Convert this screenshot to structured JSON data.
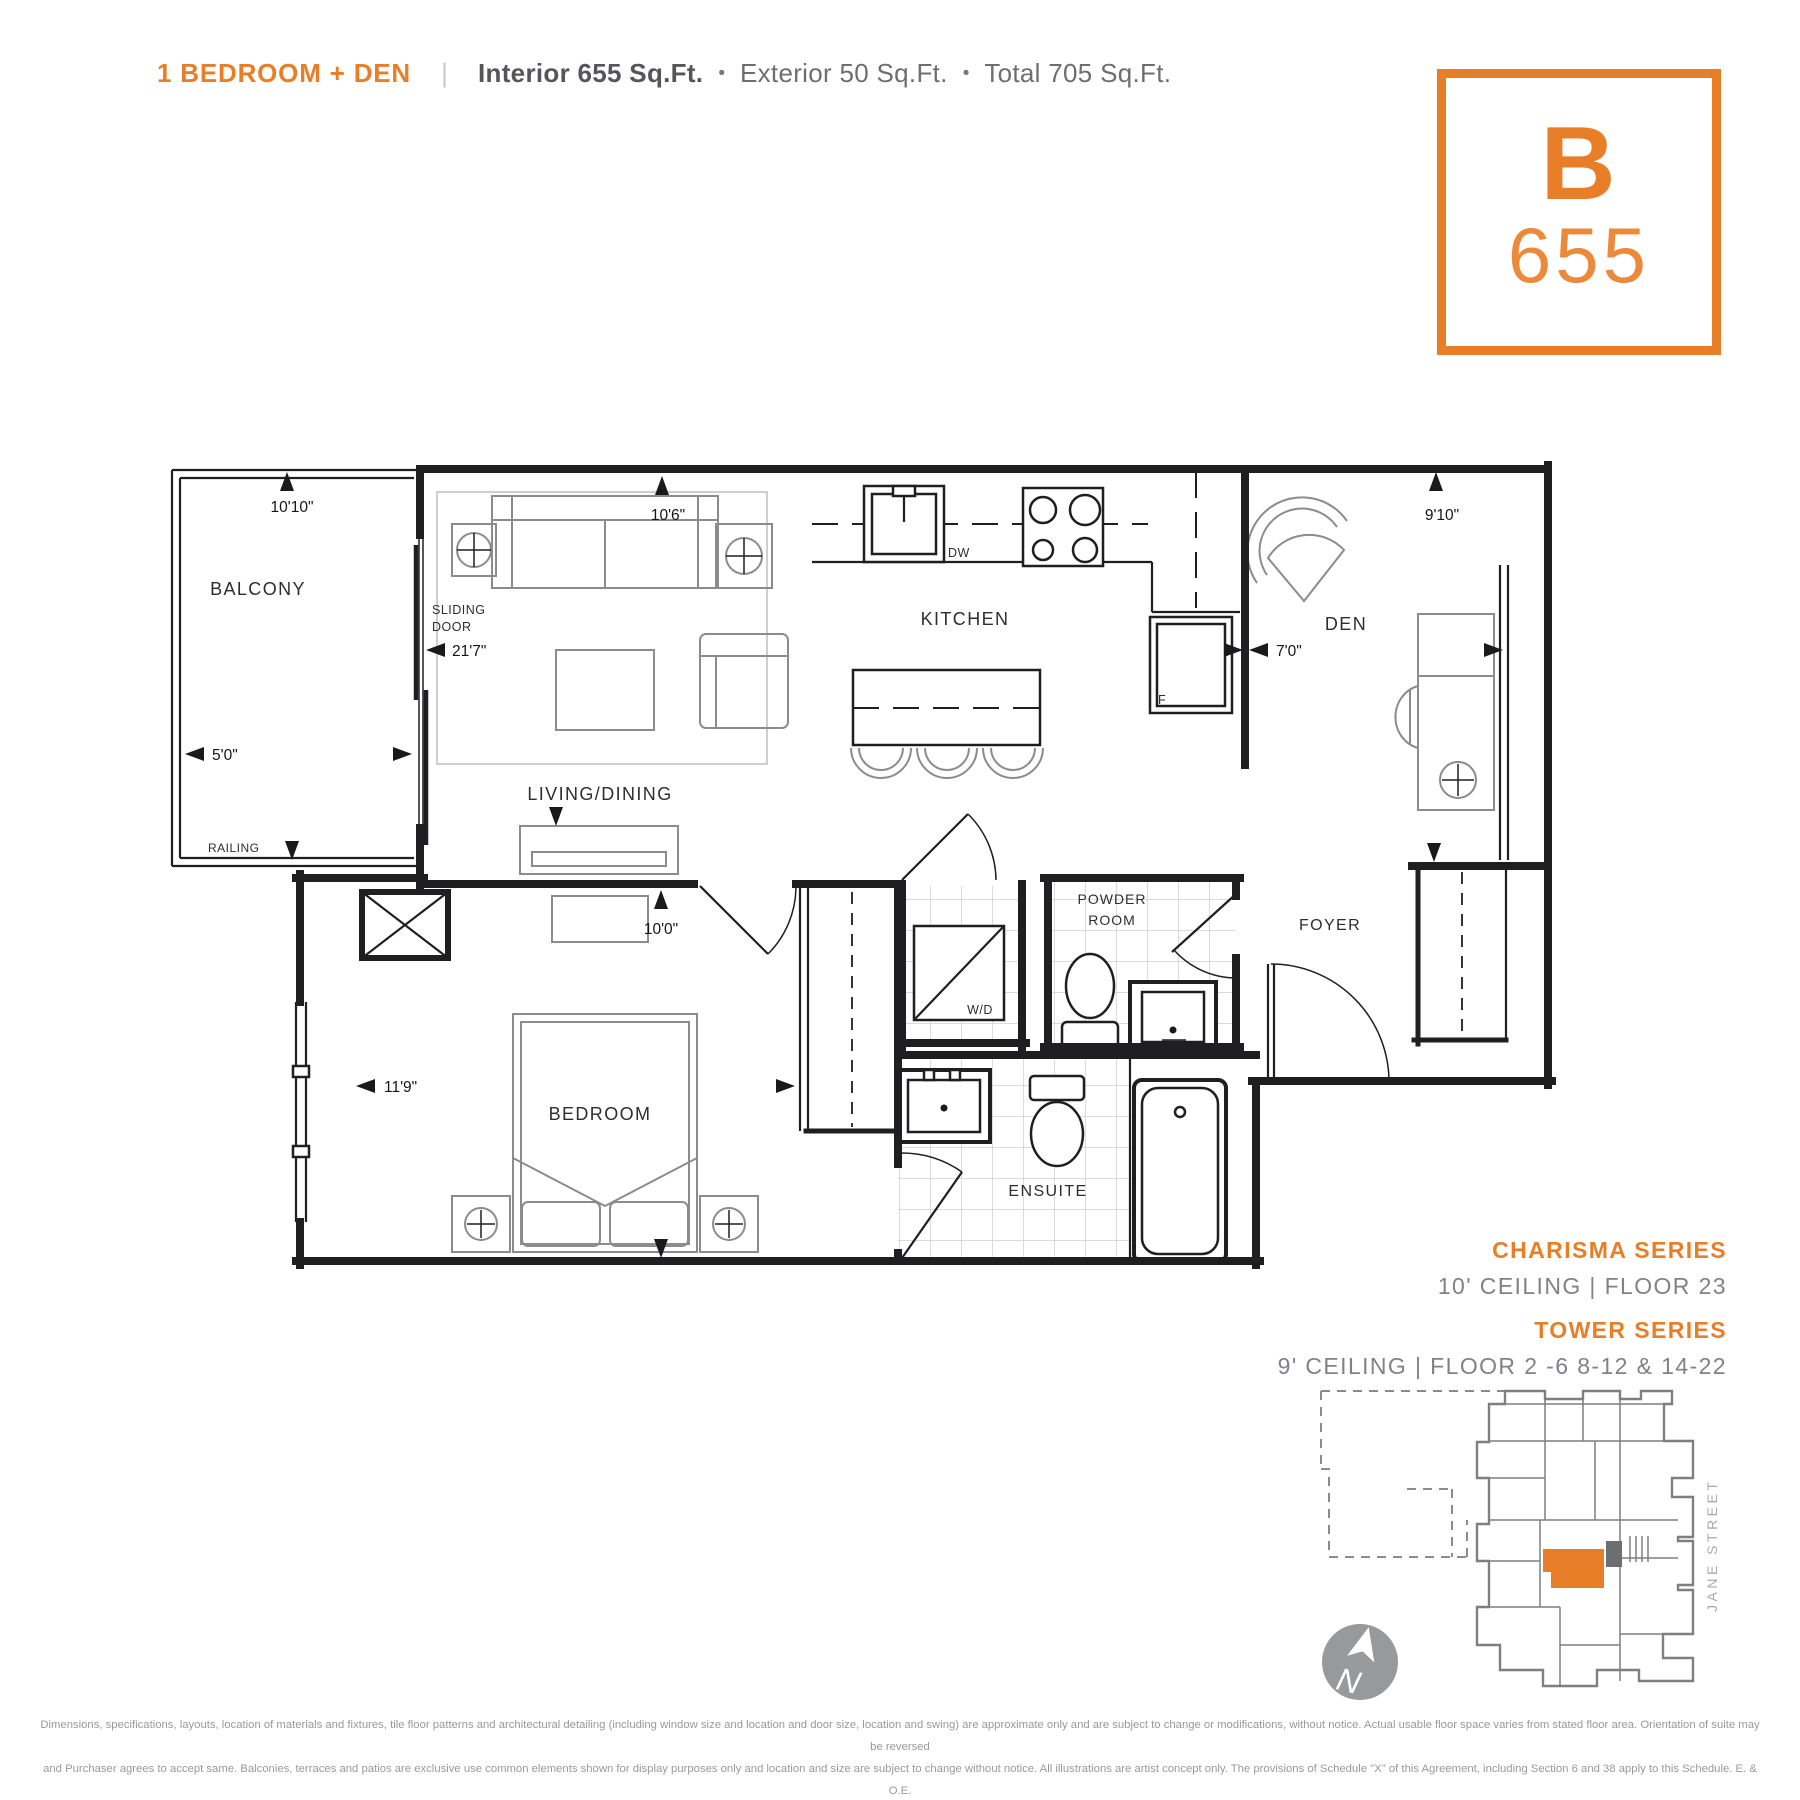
{
  "header": {
    "plan_type": "1 BEDROOM + DEN",
    "divider": "|",
    "interior": "Interior 655 Sq.Ft.",
    "bullet": "•",
    "exterior": "Exterior 50 Sq.Ft.",
    "total": "Total 705 Sq.Ft."
  },
  "badge": {
    "letter": "B",
    "number": "655"
  },
  "floorplan": {
    "rooms": {
      "balcony": "BALCONY",
      "living": "LIVING/DINING",
      "kitchen": "KITCHEN",
      "den": "DEN",
      "bedroom": "BEDROOM",
      "ensuite": "ENSUITE",
      "powder1": "POWDER",
      "powder2": "ROOM",
      "foyer": "FOYER"
    },
    "labels": {
      "sliding1": "SLIDING",
      "sliding2": "DOOR",
      "railing": "RAILING",
      "wd": "W/D",
      "dw": "DW",
      "fridge": "F"
    },
    "dims": {
      "balcony_len": "10'10\"",
      "balcony_dep": "5'0\"",
      "living_len": "21'7\"",
      "living_wid": "10'6\"",
      "den_len": "9'10\"",
      "den_wid": "7'0\"",
      "bedroom_wid": "10'0\"",
      "bedroom_len": "11'9\""
    }
  },
  "series": {
    "charisma_title": "CHARISMA SERIES",
    "charisma_detail": "10' CEILING | FLOOR 23",
    "tower_title": "TOWER SERIES",
    "tower_detail": "9' CEILING | FLOOR 2 -6 8-12 & 14-22"
  },
  "keyplan": {
    "street_label": "JANE STREET",
    "north_label": "N"
  },
  "disclaimer": {
    "line1": "Dimensions, specifications, layouts, location of materials and fixtures, tile floor patterns and architectural detailing (including window size and location and door size, location and swing) are approximate only and are subject to change or modifications, without notice. Actual usable floor space varies from stated floor area. Orientation of suite may be reversed",
    "line2": "and Purchaser agrees to accept same. Balconies, terraces and patios are exclusive use common elements shown for display purposes only and location and size are subject to change without notice. All illustrations are artist concept only. The provisions of Schedule \"X\" of this Agreement, including Section 6 and 38 apply to this Schedule. E. & O.E."
  },
  "colors": {
    "accent_orange": "#E87E27",
    "dark_text": "#55565A",
    "gray_text": "#808285",
    "plan_line": "#1F1F21",
    "keyplan_gray": "#7D7F82"
  }
}
